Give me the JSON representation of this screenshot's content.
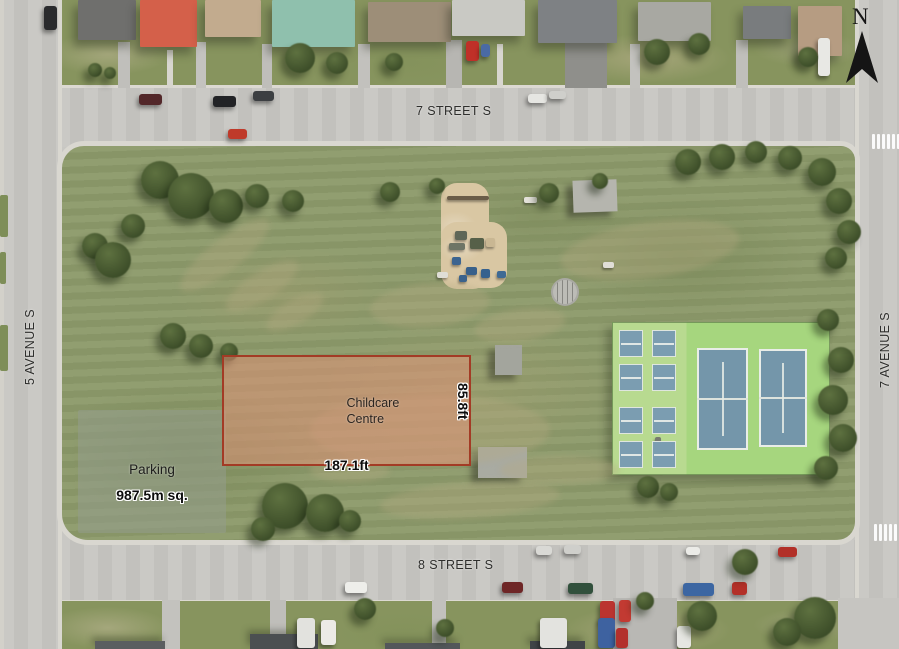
{
  "streets": {
    "north": "7 STREET S",
    "south": "8 STREET S",
    "west": "5 AVENUE S",
    "east": "7 AVENUE S"
  },
  "site": {
    "name_line1": "Childcare",
    "name_line2": "Centre",
    "width_label": "187.1ft",
    "depth_label": "85.8ft",
    "fill": "#e0917a",
    "border": "#a33b25"
  },
  "parking": {
    "label": "Parking",
    "area_label": "987.5m sq.",
    "fill": "#949c8c"
  },
  "compass": {
    "label": "N"
  },
  "palette": {
    "grass": "#8d9a6b",
    "road": "#c8c7c3",
    "sand": "#d9c7a3",
    "court_blue": "#7496aa",
    "court_apron_green": "#a6d67e",
    "tree_green": "#44552c"
  }
}
